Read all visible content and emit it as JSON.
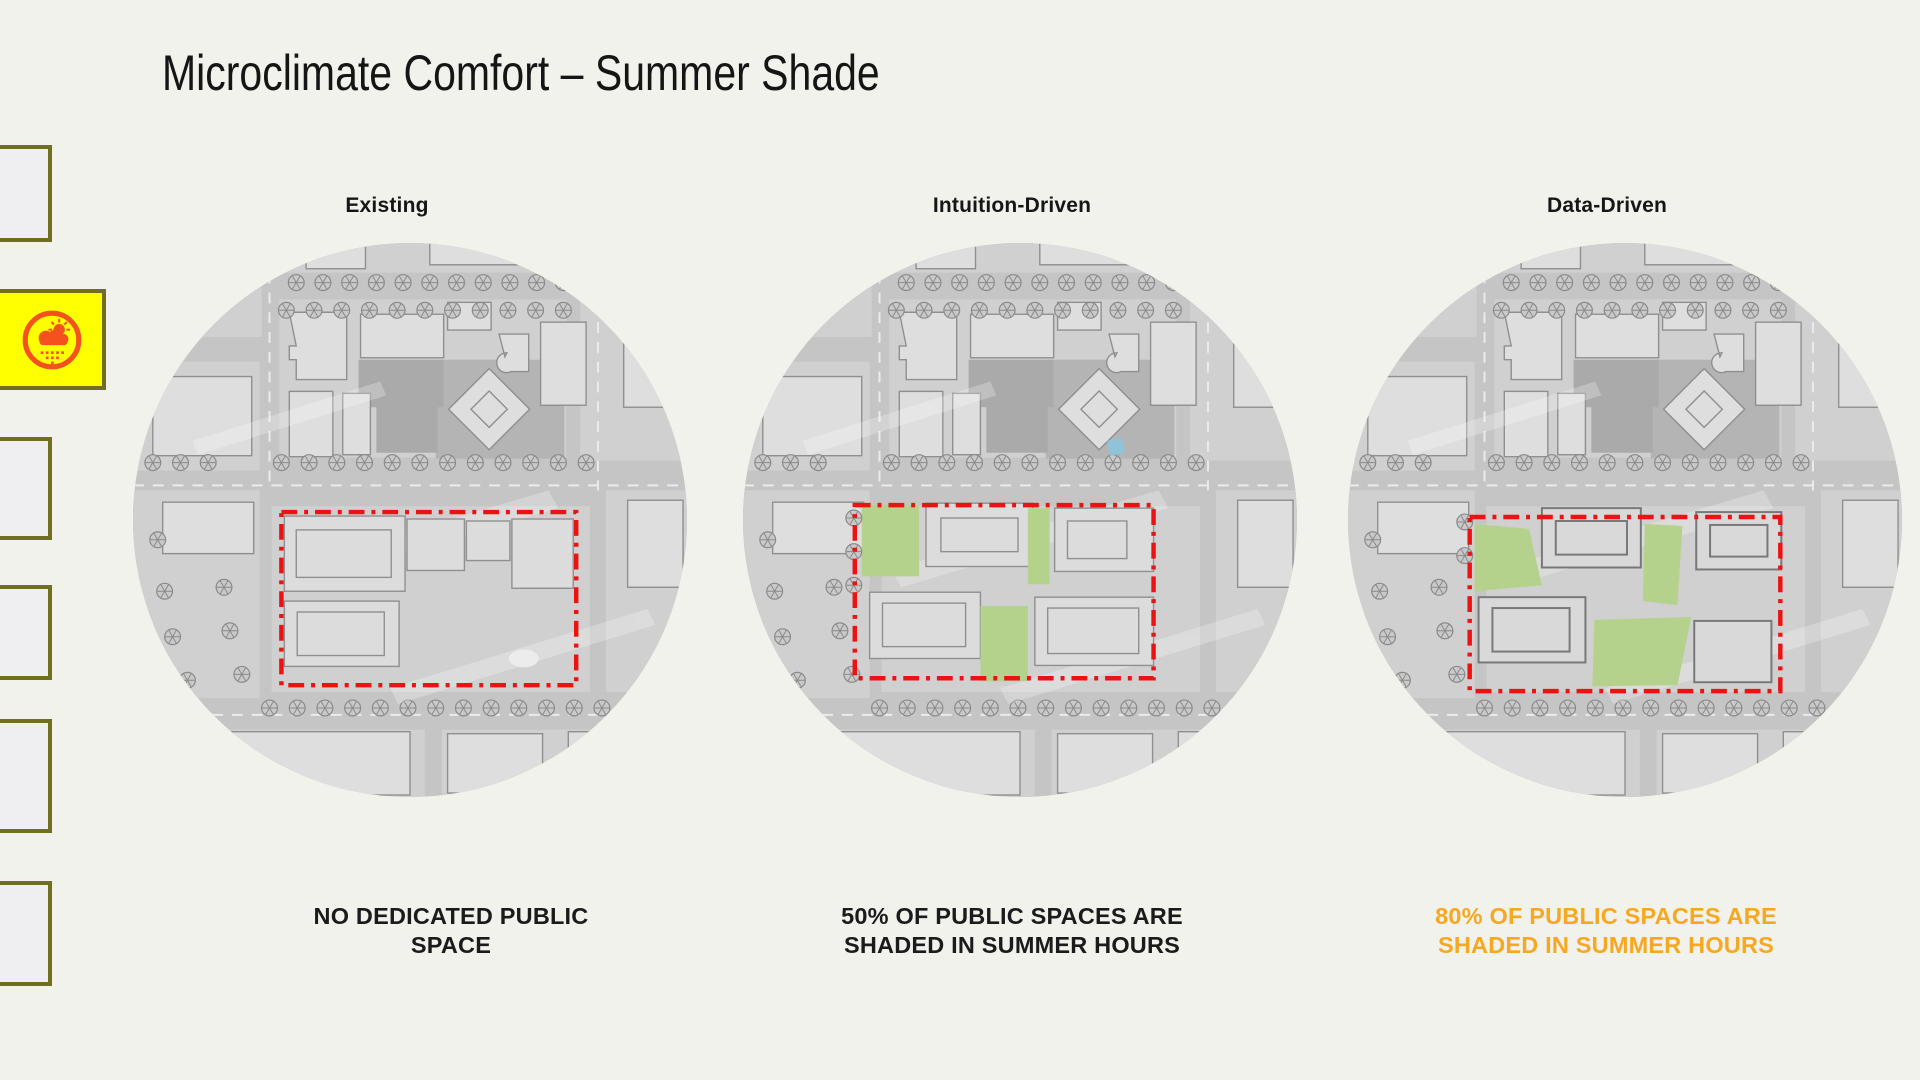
{
  "slide": {
    "title": "Microclimate Comfort – Summer Shade",
    "columns": [
      {
        "label": "Existing",
        "caption_line1": "NO DEDICATED PUBLIC",
        "caption_line2": "SPACE",
        "caption_color": "#1B1B1B"
      },
      {
        "label": "Intuition-Driven",
        "caption_line1": "50% OF PUBLIC SPACES ARE",
        "caption_line2": "SHADED IN SUMMER HOURS",
        "caption_color": "#1B1B1B"
      },
      {
        "label": "Data-Driven",
        "caption_line1": "80% OF PUBLIC SPACES ARE",
        "caption_line2": "SHADED IN SUMMER HOURS",
        "caption_color": "#F7A823"
      }
    ]
  },
  "colors": {
    "background": "#F2F2EC",
    "site_boundary_red": "#EC1212",
    "public_space_green": "#B5D28C",
    "map_base_gray": "#C5C5C5",
    "sidebar_border_olive": "#6F6F1E",
    "active_thumbnail_yellow": "#FFFF00",
    "weather_icon_orange": "#F4511E"
  },
  "sidebar": {
    "thumbnails": [
      {
        "name": "slide-thumbnail-1",
        "active": false
      },
      {
        "name": "slide-thumbnail-2",
        "active": true,
        "icon": "sun-cloud-rain-icon"
      },
      {
        "name": "slide-thumbnail-3",
        "active": false
      },
      {
        "name": "slide-thumbnail-4",
        "active": false
      },
      {
        "name": "slide-thumbnail-5",
        "active": false
      },
      {
        "name": "slide-thumbnail-6",
        "active": false
      }
    ]
  }
}
